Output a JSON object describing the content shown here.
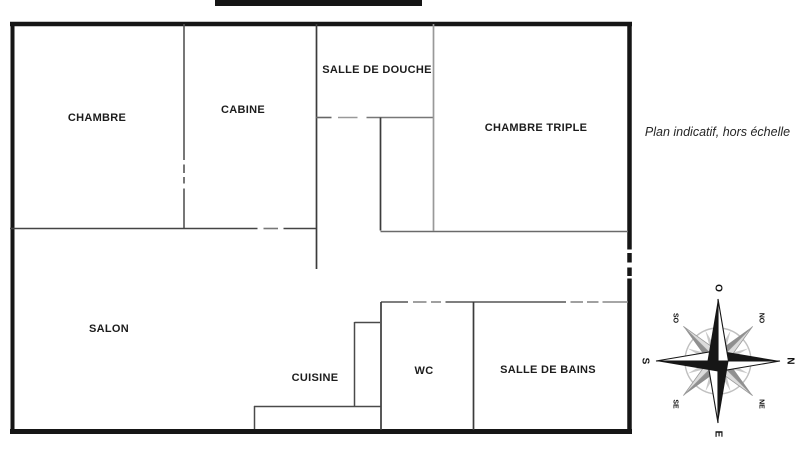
{
  "note": {
    "text": "Plan indicatif, hors échelle"
  },
  "rooms": [
    {
      "name": "CHAMBRE"
    },
    {
      "name": "CABINE"
    },
    {
      "name": "SALLE DE DOUCHE"
    },
    {
      "name": "CHAMBRE TRIPLE"
    },
    {
      "name": "SALON"
    },
    {
      "name": "CUISINE"
    },
    {
      "name": "WC"
    },
    {
      "name": "SALLE DE BAINS"
    }
  ],
  "compass": {
    "labels": {
      "n": "N",
      "s": "S",
      "e": "E",
      "o": "O",
      "ne": "NE",
      "no": "NO",
      "se": "SE",
      "so": "SO"
    }
  },
  "colors": {
    "outer_wall": "#161616",
    "interior_wall": "#4a4a4a",
    "light_wall": "#8f8f8f",
    "label_text": "#1c1c1c",
    "rose_dark": "#161616",
    "rose_gray": "#8f8f8f",
    "rose_light": "#c9c9c9"
  }
}
